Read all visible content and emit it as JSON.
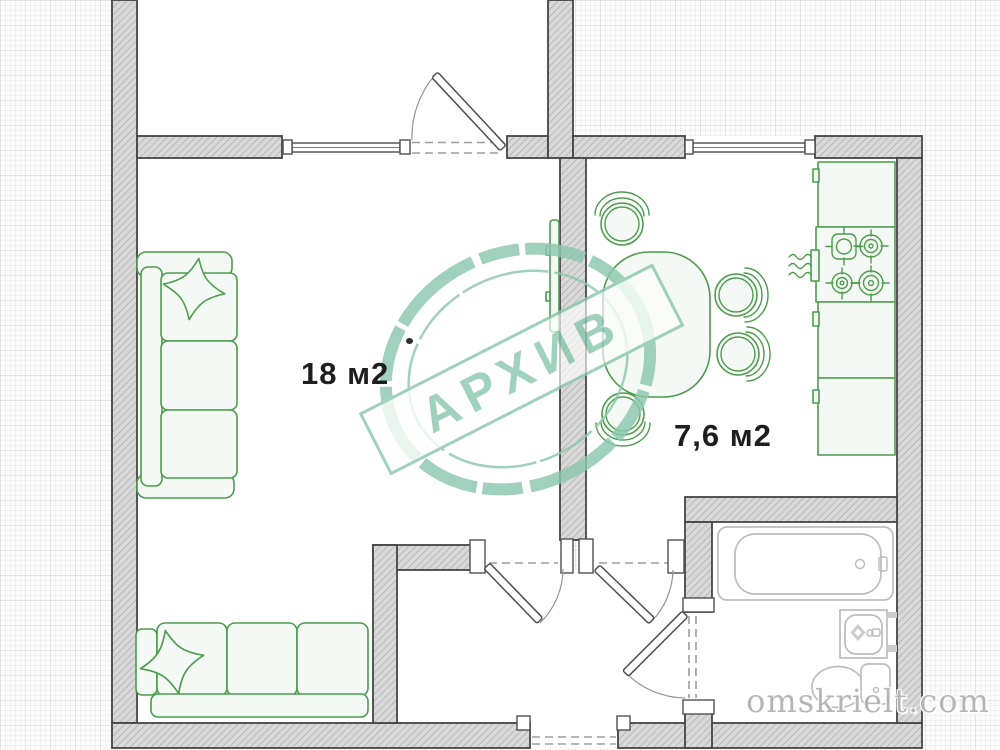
{
  "labels": {
    "living_area": "18 м2",
    "kitchen_area": "7,6 м2"
  },
  "stamp": {
    "text": "АРХИВ"
  },
  "watermark": {
    "text": "omskrielt.com"
  },
  "rooms": [
    {
      "name": "living-room",
      "area": "18 м2"
    },
    {
      "name": "kitchen",
      "area": "7,6 м2"
    },
    {
      "name": "balcony",
      "area": ""
    },
    {
      "name": "hallway",
      "area": ""
    },
    {
      "name": "bathroom",
      "area": ""
    }
  ],
  "colors": {
    "furniture_green": "#4d9c4d",
    "fixture_gray": "#bdbdbd",
    "wall_fill": "#d9d9d9",
    "wall_hatch": "#a3a3a3",
    "wall_stroke": "#454545",
    "stamp_teal": "#8cc7af",
    "room_label_color": "#1e1e1e",
    "watermark_color": "#b6b6b6"
  }
}
